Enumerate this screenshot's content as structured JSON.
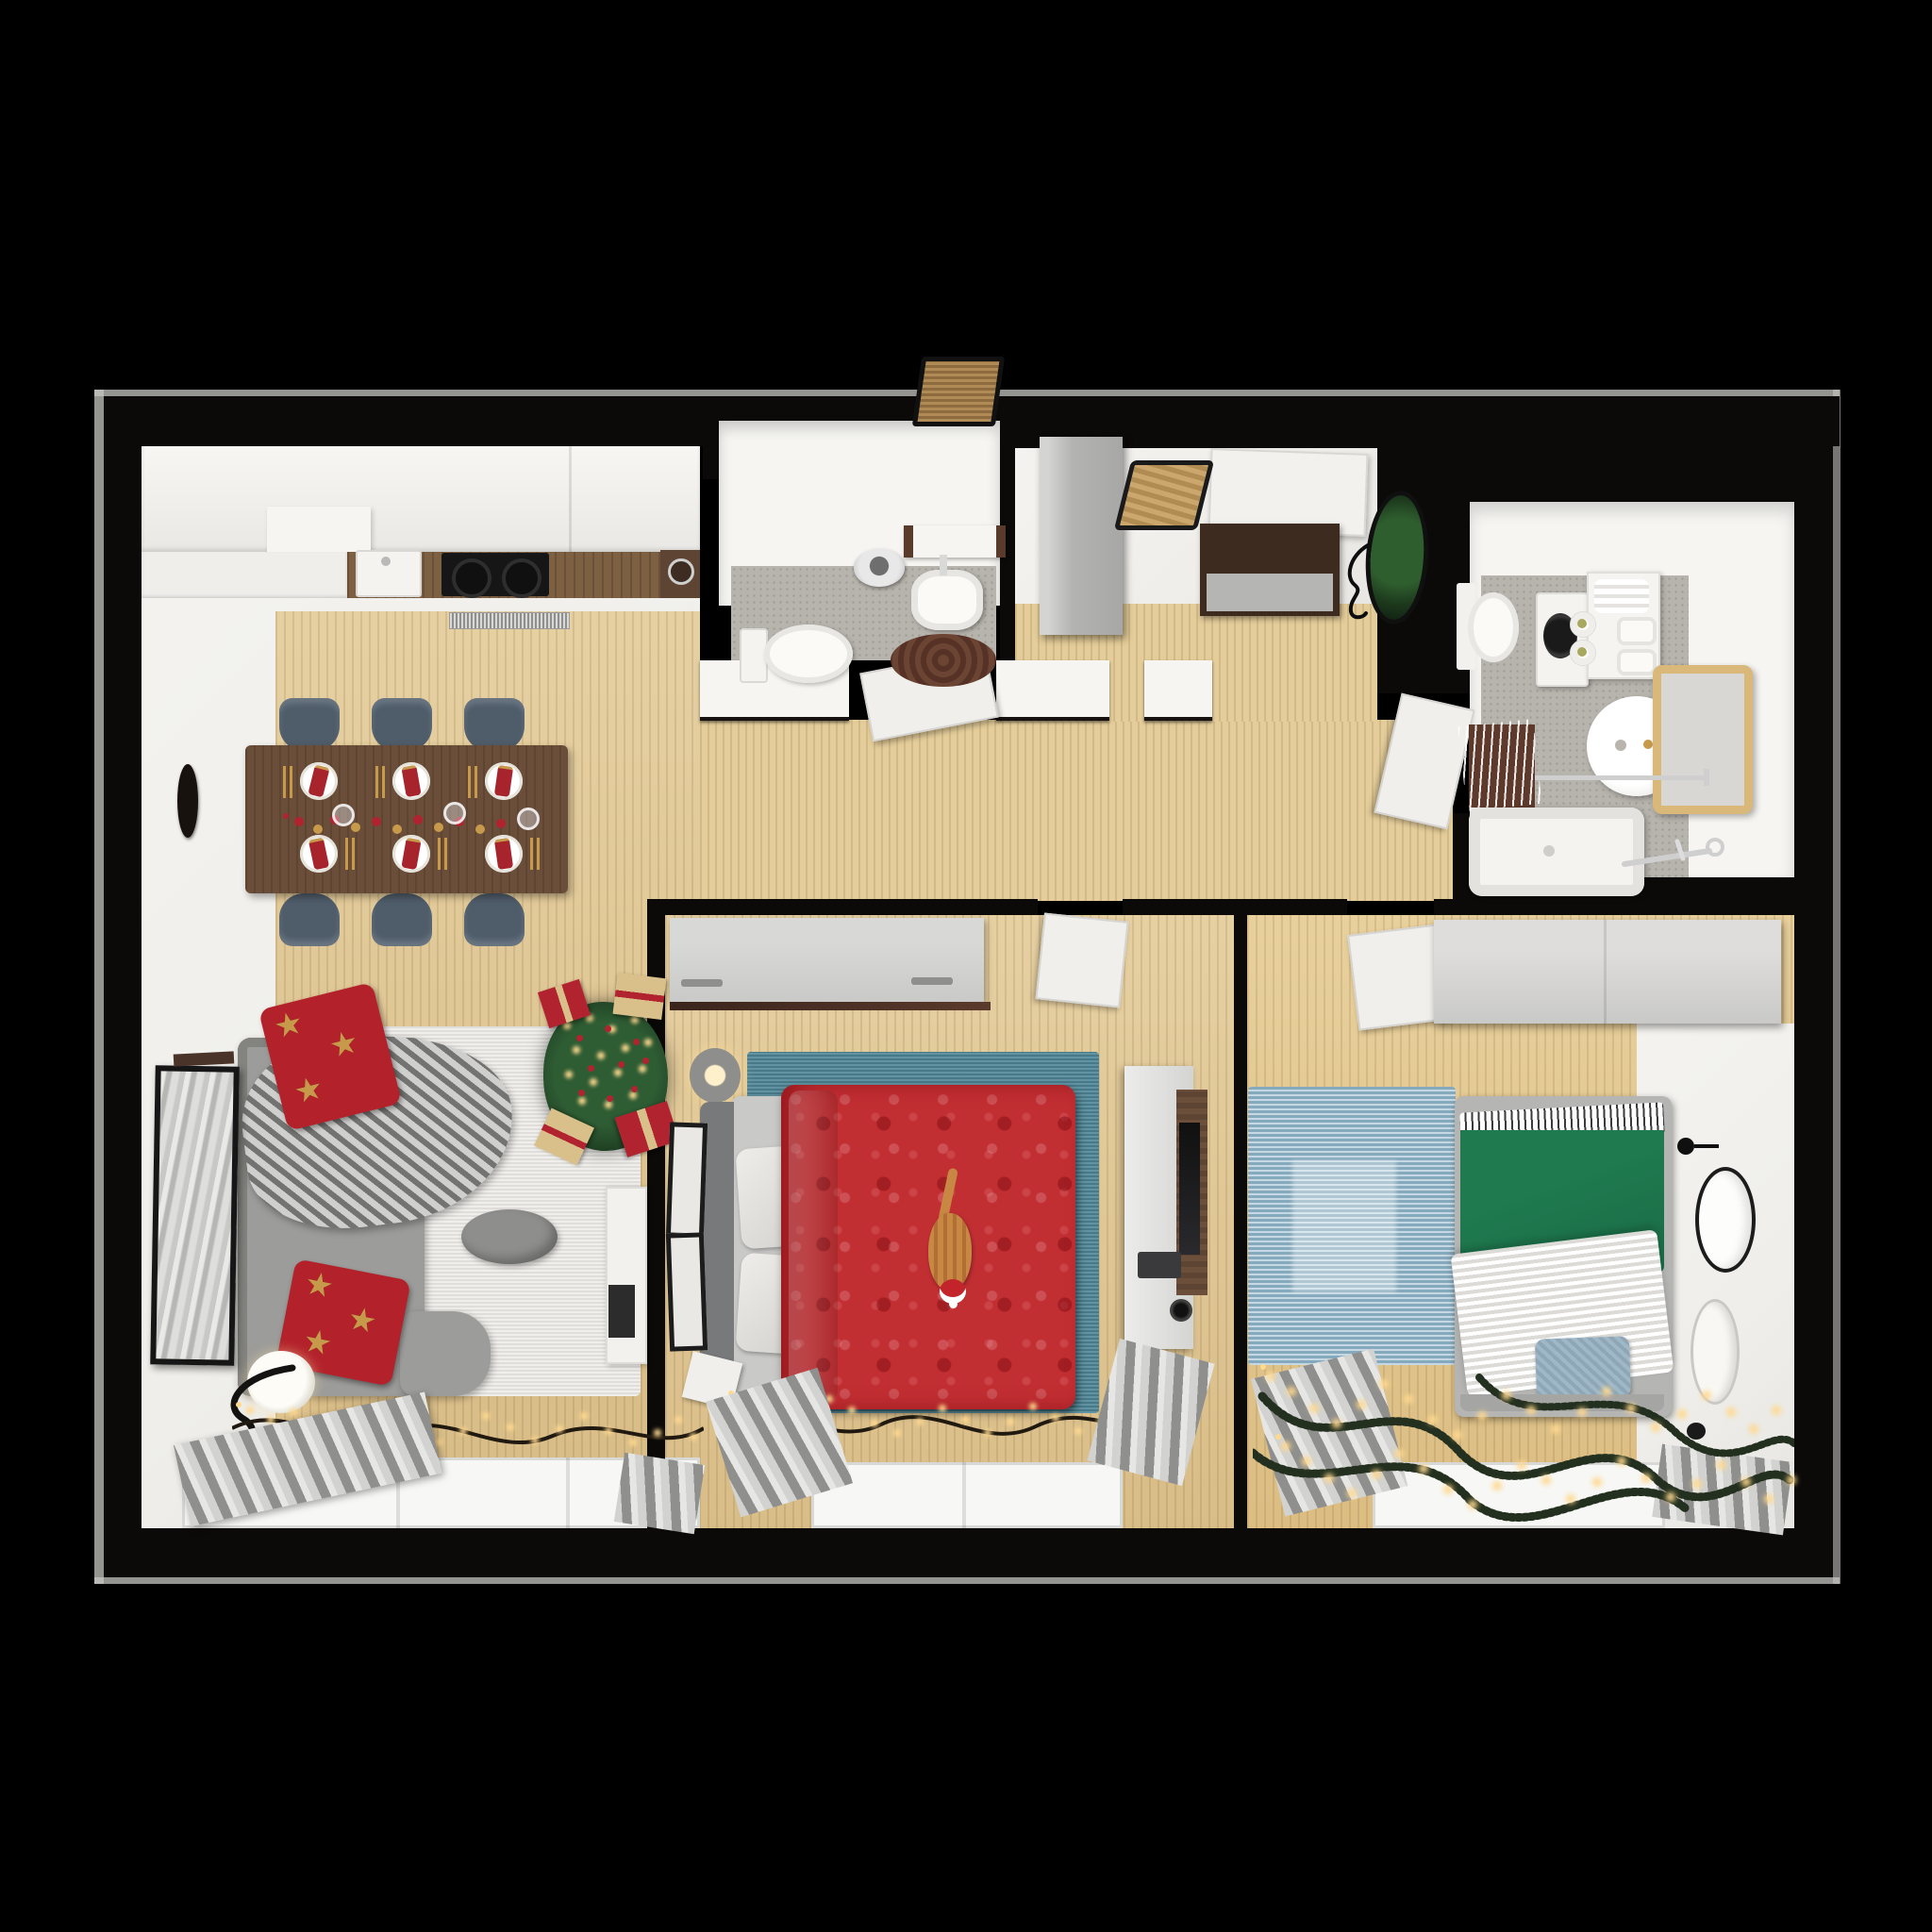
{
  "scene": {
    "type": "photorealistic 3D floor plan render, top-down view",
    "description": "Two-bedroom apartment decorated for Christmas, viewed from directly above, on a black background",
    "season_theme": "Christmas: tree with lights and gifts, red star pillows, string lights along windows, cat with santa hat on master bed"
  },
  "palette": {
    "bg": "#000000",
    "slab": "#c6c5c2",
    "wall": "#0b0a09",
    "white_floor": "#efeeea",
    "white_wall": "#f6f5f2",
    "wood": "#e6d0a2",
    "wood_deep": "#d9bd88",
    "hall_wood": "#e4cd9a",
    "gray_floor": "#b7b3ad",
    "counter_wood": "#7d5f41",
    "walnut": "#5d4433",
    "cooktop": "#161616",
    "chair": "#4f5d6b",
    "table": "#6a4e39",
    "napkin": "#a8242c",
    "gold": "#c79a4b",
    "light": "#ffd98f",
    "sofa": "#9c9c9a",
    "sofa_edge": "#83837f",
    "blanket1": "#cfcfcd",
    "blanket2": "#737371",
    "rug_white": "#eceae6",
    "pouf": "#8e8e8c",
    "tree": "#2e5c33",
    "tree_dark": "#1f4023",
    "gift_red": "#b22330",
    "gift_gold": "#d9c08a",
    "red": "#b3222b",
    "duvet_red": "#c22f33",
    "teal": "#4d8495",
    "blue_rug": "#a6c4d4",
    "green": "#1a6b45",
    "blanket_white": "#f2f1ed",
    "pillow_blue": "#9fb8c8",
    "wardrobe": "#c9c9c7",
    "gray_cab": "#b3b4b2",
    "rail": "#4a2e22",
    "console": "#3d2b20",
    "console_gray": "#b5b5b3",
    "bench": "#c9a36a",
    "mirror_dark": "#17120e",
    "plant": "#2e5d2e",
    "curtain1": "#d2d2d0",
    "curtain2": "#8f8f8d",
    "window": "#f7f7f5",
    "brown": "#5e3a2c",
    "tub": "#f4f3f0",
    "metal": "#cfcfcf",
    "cat": "#c98744",
    "hat": "#c3232a"
  },
  "rooms": [
    {
      "id": "living-dining-kitchen",
      "name": "Open living room with kitchen and dining area",
      "items": [
        "kitchen counter with sink and cooktop",
        "floor vent grille",
        "dining table set for six with red napkins and gold cutlery",
        "six slate-blue chairs",
        "oval wall mirror",
        "gray corner sofa with knit blanket",
        "two red star pillows",
        "white rug",
        "gray pouf",
        "christmas tree with lights and gifts",
        "floor lamp",
        "marble wall art",
        "string lights",
        "window with gray curtains"
      ]
    },
    {
      "id": "bathroom-main",
      "name": "Main bathroom",
      "items": [
        "toilet",
        "pendant light",
        "round washbasin",
        "shelf",
        "brown round rug"
      ]
    },
    {
      "id": "entry-hall",
      "name": "Entry hall",
      "items": [
        "front door",
        "door mat",
        "gray wardrobe cabinet",
        "wooden bench",
        "walnut shoe console",
        "oval mirror with plant reflection",
        "line-art wall decor"
      ]
    },
    {
      "id": "bathroom-laundry",
      "name": "Second bathroom with laundry",
      "items": [
        "toilet",
        "washing machine",
        "towel cabinet with baskets",
        "round basin",
        "wood-framed mirror",
        "towel rail",
        "drying rack on brown mat",
        "bathtub",
        "shower fittings"
      ]
    },
    {
      "id": "hallway",
      "name": "Hallway with wood flooring",
      "items": [
        "doors to both bedrooms and bathrooms"
      ]
    },
    {
      "id": "bedroom-master",
      "name": "Master bedroom",
      "items": [
        "sliding-door wardrobe",
        "double bed with red damask duvet",
        "ginger cat wearing santa hat",
        "teal rug",
        "bedside lamp",
        "two leaning picture frames",
        "TV unit with wall TV",
        "media device and speaker",
        "nightstand",
        "string lights",
        "window with gray curtains"
      ]
    },
    {
      "id": "bedroom-second",
      "name": "Second bedroom",
      "items": [
        "wardrobe",
        "single bed with green duvet and striped sheet",
        "white knit blanket",
        "blue pillow",
        "light-blue rug",
        "wall clock",
        "round wall plate",
        "wall hook",
        "lit pine garlands",
        "window with gray curtains"
      ]
    }
  ]
}
